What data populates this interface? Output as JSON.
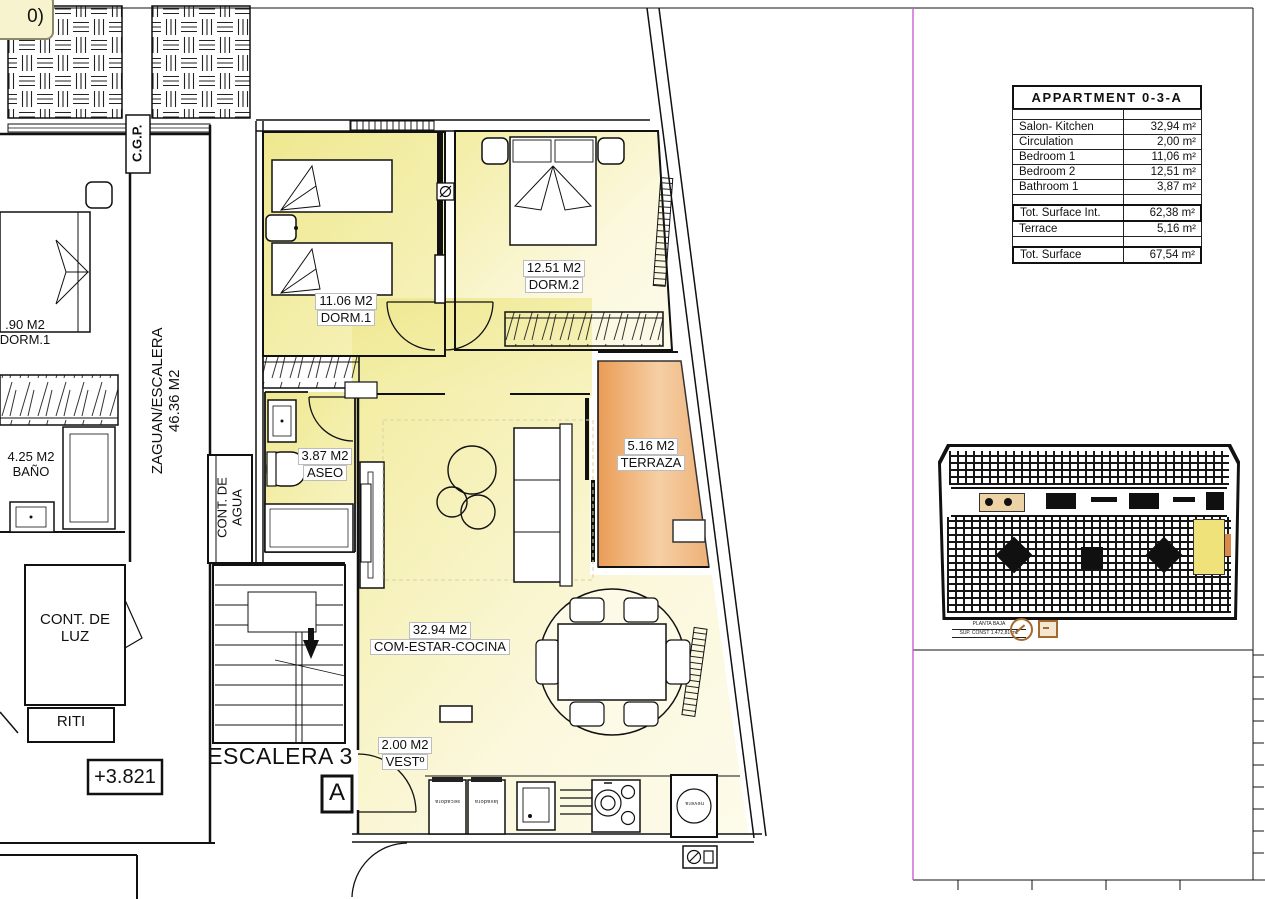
{
  "page": {
    "corner_note": "0)"
  },
  "plan": {
    "rooms": {
      "dorm1": {
        "area": "11.06 M2",
        "name": "DORM.1"
      },
      "dorm2": {
        "area": "12.51 M2",
        "name": "DORM.2"
      },
      "aseo": {
        "area": "3.87 M2",
        "name": "ASEO"
      },
      "terraza": {
        "area": "5.16 M2",
        "name": "TERRAZA"
      },
      "salon": {
        "area": "32.94 M2",
        "name": "COM-ESTAR-COCINA"
      },
      "vest": {
        "area": "2.00 M2",
        "name": "VESTº"
      },
      "neighbor_dorm": {
        "area": ".90 M2",
        "name": "DORM.1"
      },
      "bano": {
        "area": "4.25 M2",
        "name": "BAÑO"
      },
      "cont_luz": {
        "line1": "CONT. DE",
        "line2": "LUZ"
      },
      "riti": "RITI",
      "zaguan": {
        "line1": "ZAGUAN/ESCALERA",
        "line2": "46.36 M2"
      },
      "cont_agua": {
        "line1": "CONT. DE",
        "line2": "AGUA"
      },
      "cgp": "C.G.P.",
      "escalera": "ESCALERA 3",
      "section_mark": "A",
      "level": "+3.821"
    },
    "appliances": {
      "w1": "secadora",
      "w2": "lavadora",
      "fridge": "nevera"
    }
  },
  "summary_table": {
    "title": "APPARTMENT 0-3-A",
    "rows": [
      {
        "label": "Salon- Kitchen",
        "value": "32,94 m²"
      },
      {
        "label": "Circulation",
        "value": "2,00 m²"
      },
      {
        "label": "Bedroom 1",
        "value": "11,06 m²"
      },
      {
        "label": "Bedroom 2",
        "value": "12,51 m²"
      },
      {
        "label": "Bathroom 1",
        "value": "3,87 m²"
      }
    ],
    "totals": [
      {
        "label": "Tot. Surface Int.",
        "value": "62,38 m²"
      },
      {
        "label": "Terrace",
        "value": "5,16 m²"
      },
      {
        "label": "Tot. Surface",
        "value": "67,54 m²"
      }
    ]
  },
  "key_plan": {
    "caption_line1": "PLANTA BAJA",
    "caption_line2": "SUP. CONST 1.472,81 m2"
  },
  "colors": {
    "room_yellow": "#f0ea97",
    "room_pale": "#fbf8e0",
    "terrace_orange": "#eda05c",
    "line": "#1a1a1a",
    "divider_magenta": "#cc5fd0",
    "keyplan_highlight": "#efe27a",
    "compass_tan": "#a5692c"
  }
}
